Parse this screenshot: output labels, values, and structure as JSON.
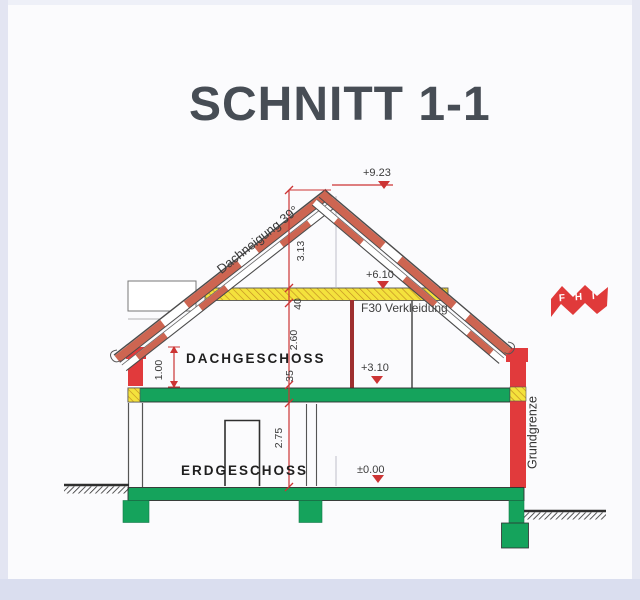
{
  "page": {
    "title": "SCHNITT 1-1"
  },
  "drawing": {
    "labels": {
      "roof_pitch": "Dachneigung 39°",
      "cladding": "F30 Verkleidung",
      "attic_floor": "DACHGESCHOSS",
      "ground_floor": "ERDGESCHOSS",
      "boundary": "Grundgrenze"
    },
    "levels": {
      "ridge": "+9.23",
      "attic_ceiling": "+6.10",
      "upper_floor": "+3.10",
      "ground_floor": "±0.00"
    },
    "dimensions": {
      "ridge_to_ceiling": "3.13",
      "ceiling_thickness": "40",
      "attic_room_height": "2.60",
      "floor_slab": "35",
      "ground_room_height": "2.75",
      "knee_wall": "1.00"
    }
  },
  "logo": {
    "letters": [
      "F",
      "H",
      "I"
    ]
  },
  "colors": {
    "roof_red": "#cd6551",
    "wall_red": "#e13a3c",
    "slab_green": "#15a35c",
    "insulation_yellow": "#f4e23c",
    "dimension_red": "#cc3434",
    "logo_red": "#e03a3a",
    "line_dark": "#4a4a4a"
  }
}
